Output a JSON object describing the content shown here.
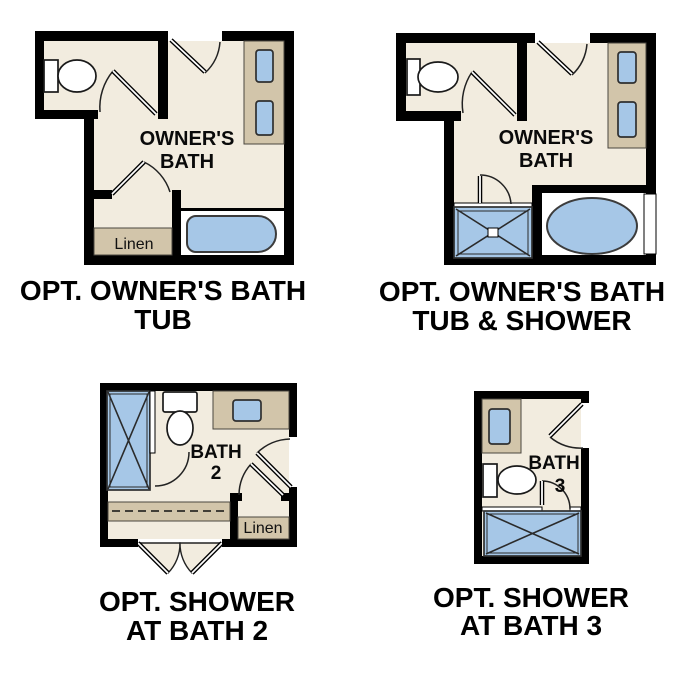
{
  "colors": {
    "background": "#ffffff",
    "wall": "#000000",
    "floor": "#f2ecdf",
    "counter": "#d2c5aa",
    "fixture": "#a6c7e7",
    "text": "#000000"
  },
  "plans": [
    {
      "room_label_line1": "OWNER'S",
      "room_label_line2": "BATH",
      "linen_label": "Linen",
      "caption_line1": "OPT. OWNER'S BATH",
      "caption_line2": "TUB"
    },
    {
      "room_label_line1": "OWNER'S",
      "room_label_line2": "BATH",
      "caption_line1": "OPT. OWNER'S BATH",
      "caption_line2": "TUB & SHOWER"
    },
    {
      "room_label_line1": "BATH",
      "room_label_line2": "2",
      "linen_label": "Linen",
      "caption_line1": "OPT. SHOWER",
      "caption_line2": "AT BATH 2"
    },
    {
      "room_label_line1": "BATH",
      "room_label_line2": "3",
      "caption_line1": "OPT. SHOWER",
      "caption_line2": "AT BATH 3"
    }
  ]
}
